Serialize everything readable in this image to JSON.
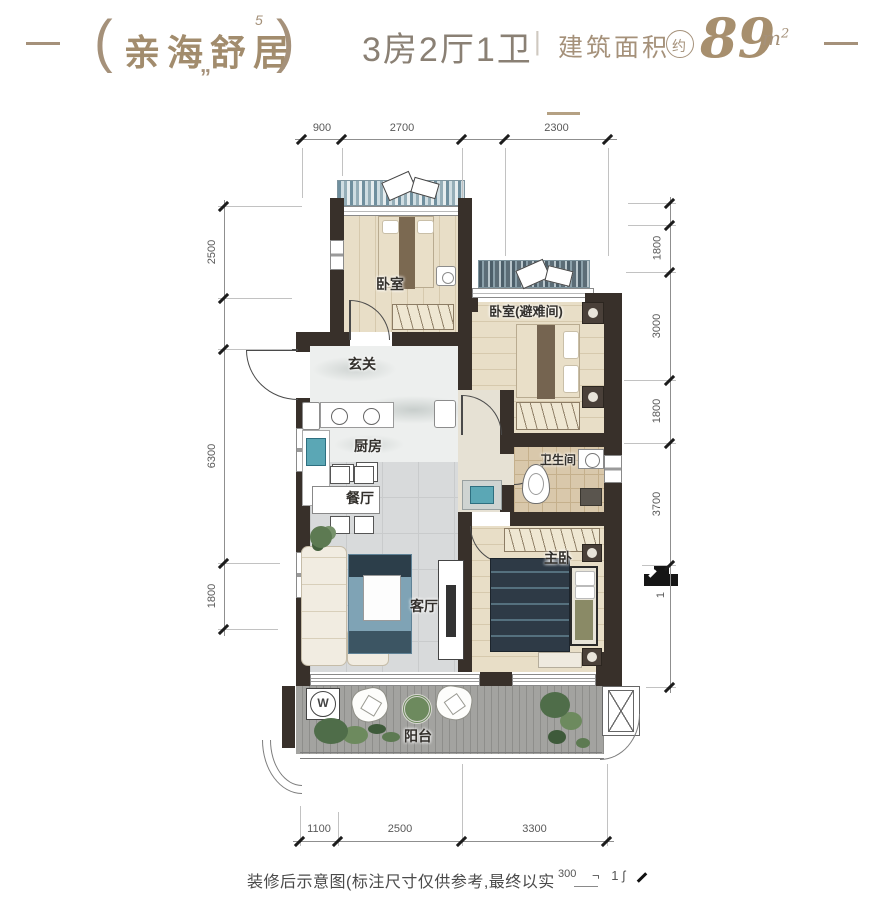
{
  "header": {
    "dash_left": "—",
    "dash_right": "—",
    "bracket_left": "(",
    "bracket_right": ")",
    "deco_quotes": "„",
    "deco_flag": "5",
    "title": "亲海舒居",
    "layout_info": "3房2厅1卫",
    "separator": "|",
    "area_label": "建筑面积",
    "area_circle": "约",
    "area_value": "89",
    "area_unit_base": "m",
    "area_unit_sup": "2"
  },
  "rooms": {
    "bedroom1": "卧室",
    "bedroom2": "卧室(避难间)",
    "entry": "玄关",
    "kitchen": "厨房",
    "dining": "餐厅",
    "bathroom": "卫生间",
    "living": "客厅",
    "master": "主卧",
    "balcony": "阳台"
  },
  "symbols": {
    "washer_letter": "W"
  },
  "dims": {
    "top": [
      "900",
      "2700",
      "2300"
    ],
    "bottom": [
      "1100",
      "2500",
      "3300"
    ],
    "left": [
      "2500",
      "6300",
      "1800"
    ],
    "right": [
      "1800",
      "3000",
      "1800",
      "3700"
    ],
    "right_small": "1"
  },
  "footer": {
    "note": "装修后示意图(标注尺寸仅供参考,最终以实",
    "frag_dim": "300",
    "frag_marks": "¬ 1ʃ"
  }
}
